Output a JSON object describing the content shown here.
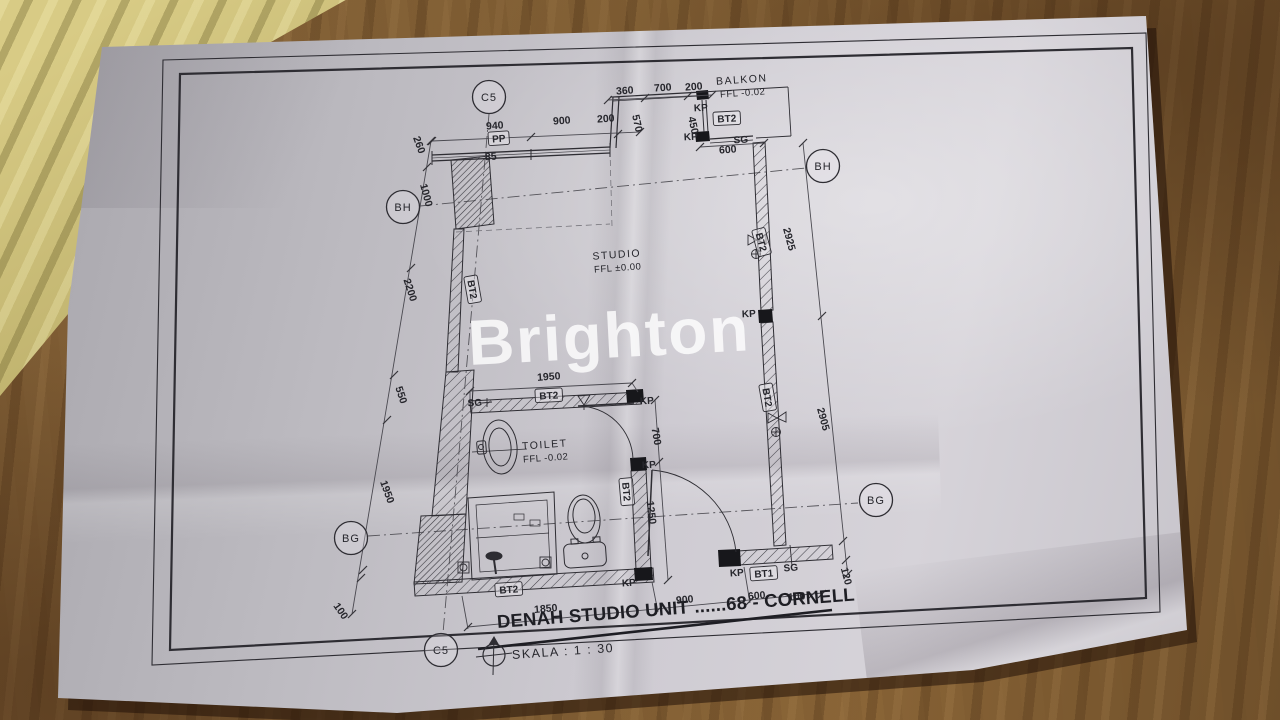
{
  "watermark": {
    "text": "Brighton"
  },
  "title_block": {
    "title": "DENAH STUDIO UNIT ......68 - CORNELL",
    "scale_label": "SKALA : 1 : 30",
    "compass_icon": "north-arrow-icon"
  },
  "rooms": [
    {
      "name": "STUDIO",
      "ffl": "FFL ±0.00",
      "x": 617,
      "y": 258,
      "r": -4
    },
    {
      "name": "TOILET",
      "ffl": "FFL -0.02",
      "x": 545,
      "y": 448,
      "r": -4
    },
    {
      "name": "BALKON",
      "ffl": "FFL -0.02",
      "x": 742,
      "y": 83,
      "r": -4
    }
  ],
  "grid_bubbles": [
    {
      "t": "C5",
      "x": 489,
      "y": 97
    },
    {
      "t": "BH",
      "x": 403,
      "y": 207
    },
    {
      "t": "BG",
      "x": 351,
      "y": 538
    },
    {
      "t": "C5",
      "x": 441,
      "y": 650
    },
    {
      "t": "BH",
      "x": 823,
      "y": 166
    },
    {
      "t": "BG",
      "x": 876,
      "y": 500
    }
  ],
  "dim_labels": [
    {
      "t": "940",
      "x": 495,
      "y": 129,
      "r": -4
    },
    {
      "t": "900",
      "x": 562,
      "y": 124,
      "r": -4
    },
    {
      "t": "200",
      "x": 606,
      "y": 122,
      "r": -4
    },
    {
      "t": "360",
      "x": 625,
      "y": 94,
      "r": -4
    },
    {
      "t": "700",
      "x": 663,
      "y": 91,
      "r": -4
    },
    {
      "t": "200",
      "x": 694,
      "y": 90,
      "r": -4
    },
    {
      "t": "570",
      "x": 634,
      "y": 124,
      "r": 78
    },
    {
      "t": "450",
      "x": 690,
      "y": 126,
      "r": 78
    },
    {
      "t": "600",
      "x": 728,
      "y": 153,
      "r": -4
    },
    {
      "t": "85",
      "x": 491,
      "y": 160,
      "r": -4
    },
    {
      "t": "260",
      "x": 416,
      "y": 146,
      "r": 70
    },
    {
      "t": "1000",
      "x": 423,
      "y": 196,
      "r": 75
    },
    {
      "t": "2200",
      "x": 407,
      "y": 291,
      "r": 72
    },
    {
      "t": "550",
      "x": 398,
      "y": 396,
      "r": 72
    },
    {
      "t": "1950",
      "x": 384,
      "y": 493,
      "r": 70
    },
    {
      "t": "100",
      "x": 338,
      "y": 613,
      "r": 55
    },
    {
      "t": "1950",
      "x": 549,
      "y": 380,
      "r": -4
    },
    {
      "t": "700",
      "x": 653,
      "y": 437,
      "r": 80
    },
    {
      "t": "1250",
      "x": 648,
      "y": 513,
      "r": 83
    },
    {
      "t": "2925",
      "x": 786,
      "y": 240,
      "r": 75
    },
    {
      "t": "2905",
      "x": 820,
      "y": 420,
      "r": 75
    },
    {
      "t": "120",
      "x": 843,
      "y": 577,
      "r": 75
    },
    {
      "t": "1850",
      "x": 546,
      "y": 612,
      "r": -5
    },
    {
      "t": "900",
      "x": 685,
      "y": 603,
      "r": -5
    },
    {
      "t": "600",
      "x": 757,
      "y": 599,
      "r": -5
    },
    {
      "t": "100",
      "x": 797,
      "y": 600,
      "r": -5
    }
  ],
  "markers": [
    {
      "t": "PP",
      "x": 499,
      "y": 142,
      "r": -4,
      "boxed": true
    },
    {
      "t": "KP",
      "x": 701,
      "y": 111,
      "r": -3,
      "boxed": false
    },
    {
      "t": "KP",
      "x": 691,
      "y": 140,
      "r": -3,
      "boxed": false
    },
    {
      "t": "BT2",
      "x": 727,
      "y": 122,
      "r": -3,
      "boxed": true
    },
    {
      "t": "SG",
      "x": 741,
      "y": 143,
      "r": -3,
      "boxed": false
    },
    {
      "t": "KP",
      "x": 749,
      "y": 317,
      "r": -3,
      "boxed": false
    },
    {
      "t": "BT2",
      "x": 469,
      "y": 290,
      "r": 80,
      "boxed": true
    },
    {
      "t": "BT2",
      "x": 758,
      "y": 243,
      "r": 75,
      "boxed": true
    },
    {
      "t": "BT2",
      "x": 764,
      "y": 398,
      "r": 80,
      "boxed": true
    },
    {
      "t": "SG",
      "x": 475,
      "y": 406,
      "r": -3,
      "boxed": false
    },
    {
      "t": "BT2",
      "x": 549,
      "y": 399,
      "r": -3,
      "boxed": true
    },
    {
      "t": "KP",
      "x": 647,
      "y": 404,
      "r": -3,
      "boxed": false
    },
    {
      "t": "KP",
      "x": 649,
      "y": 468,
      "r": -3,
      "boxed": false
    },
    {
      "t": "BT2",
      "x": 623,
      "y": 492,
      "r": 85,
      "boxed": true
    },
    {
      "t": "BT2",
      "x": 509,
      "y": 593,
      "r": -4,
      "boxed": true
    },
    {
      "t": "KP",
      "x": 629,
      "y": 586,
      "r": -4,
      "boxed": false
    },
    {
      "t": "KP",
      "x": 737,
      "y": 576,
      "r": -4,
      "boxed": false
    },
    {
      "t": "BT1",
      "x": 764,
      "y": 577,
      "r": -4,
      "boxed": true
    },
    {
      "t": "SG",
      "x": 791,
      "y": 571,
      "r": -4,
      "boxed": false
    }
  ],
  "colors": {
    "paper": "#cfccd3",
    "ink": "#2e2d33",
    "fabric": "#96713f",
    "cloth": "#b4a763",
    "watermark": "rgba(255,255,255,0.80)"
  }
}
